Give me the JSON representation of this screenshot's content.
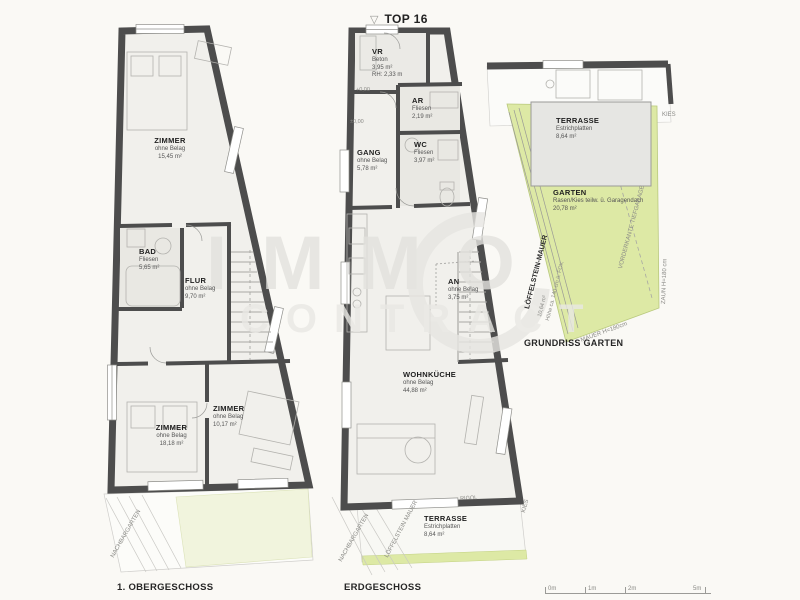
{
  "header": {
    "triangle_icon": "▽",
    "top_label": "TOP 16"
  },
  "watermark": {
    "line1": "IMMO",
    "line2": "CONTRACT"
  },
  "colors": {
    "wall": "#4d4d4d",
    "room_fill": "#f1f0ec",
    "tile_fill": "#e9e8e3",
    "garden_green": "#dde9a5",
    "pale_green": "#f1f4dd",
    "terrace_gray": "#e6e6e3",
    "watermark_gray": "#e3e2de",
    "background": "#faf9f5"
  },
  "og": {
    "caption": "1. OBERGESCHOSS",
    "rooms": [
      {
        "name": "ZIMMER",
        "sub": "ohne Belag",
        "area": "15,45 m²"
      },
      {
        "name": "BAD",
        "sub": "Fliesen",
        "area": "5,65 m²"
      },
      {
        "name": "FLUR",
        "sub": "ohne Belag",
        "area": "9,70 m²"
      },
      {
        "name": "ZIMMER",
        "sub": "ohne Belag",
        "area": "18,18 m²"
      },
      {
        "name": "ZIMMER",
        "sub": "ohne Belag",
        "area": "10,17 m²"
      }
    ],
    "annotations": {
      "nachbargarten": "NACHBARGARTEN"
    }
  },
  "eg": {
    "caption": "ERDGESCHOSS",
    "rooms": [
      {
        "name": "VR",
        "sub": "Beton",
        "area": "3,95 m²",
        "extra": "RH: 2,33 m"
      },
      {
        "name": "AR",
        "sub": "Fliesen",
        "area": "2,19 m²"
      },
      {
        "name": "GANG",
        "sub": "ohne Belag",
        "area": "5,78 m²"
      },
      {
        "name": "WC",
        "sub": "Fliesen",
        "area": "3,97 m²"
      },
      {
        "name": "AN",
        "sub": "ohne Belag",
        "area": "3,75 m²"
      },
      {
        "name": "WOHNKÜCHE",
        "sub": "ohne Belag",
        "area": "44,88 m²"
      },
      {
        "name": "TERRASSE",
        "sub": "Estrichplatten",
        "area": "8,64 m²"
      }
    ],
    "levels": {
      "l1": "+0,00",
      "l2": "±0,00"
    },
    "annotations": {
      "nachbargarten": "NACHBARGARTEN",
      "mauer": "LÖFFELSTEIN MAUER",
      "rigol": "RIGOL",
      "kies": "KIES"
    }
  },
  "garten": {
    "caption": "GRUNDRISS GARTEN",
    "rooms": [
      {
        "name": "TERRASSE",
        "sub": "Estrichplatten",
        "area": "8,64 m²"
      },
      {
        "name": "GARTEN",
        "sub": "Rasen/Kies teilw. ü. Garagendach",
        "area": "20,78 m²"
      }
    ],
    "annotations": {
      "mauer_title": "LÖFFELSTEIN-MAUER",
      "mauer_area": "10,64 m²",
      "mauer_height": "Höhe ca. 140 cm ü. FOK",
      "vorderkante": "VORDERKANTE TIEFGARAGE",
      "zaun": "ZAUN H=180 cm",
      "mauer_h": "MAUER H=180cm",
      "kies": "KIES"
    }
  },
  "scalebar": {
    "labels": [
      "0m",
      "1m",
      "2m",
      "5m"
    ]
  }
}
